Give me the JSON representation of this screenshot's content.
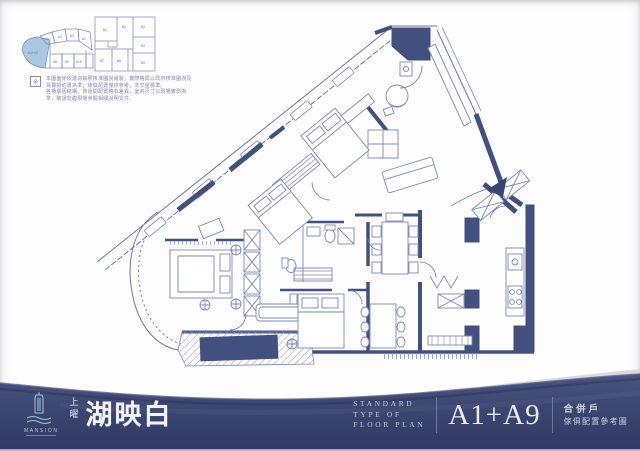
{
  "keyplan_fan": {
    "highlight": "A1+A9",
    "cells_top": [
      "A5",
      "A4",
      "A3",
      "A2"
    ],
    "cells_bottom": [
      "A8",
      "A9",
      "A10"
    ]
  },
  "keyplan_square": {
    "cells": [
      "B1",
      "B2",
      "B3",
      "B4",
      "B5",
      "B6",
      "B7"
    ]
  },
  "disclaimer": {
    "line1": "本圖面係依建造執照核准圖說繪製，實際格局以政府核准圖說及買賣契約書為準；傢俱配置僅供參考，非交屋標準。",
    "line2": "各樓層因結構、管道間配置略有差異，室內尺寸以現場實測為準，敬請蒞臨現場參閱相關說明文件。"
  },
  "footer": {
    "brand_en": "MANSION",
    "brand_vert": "上曜",
    "title": "湖映白",
    "std_l1": "STANDARD",
    "std_l2": "TYPE OF",
    "std_l3": "FLOOR PLAN",
    "unit": "A1+A9",
    "cn1": "合併戶",
    "cn2": "傢俱配置參考圖"
  },
  "colors": {
    "navy": "#3b4671",
    "line": "#6d78a7",
    "wall": "#41507e",
    "highlight": "#aac7e2"
  }
}
